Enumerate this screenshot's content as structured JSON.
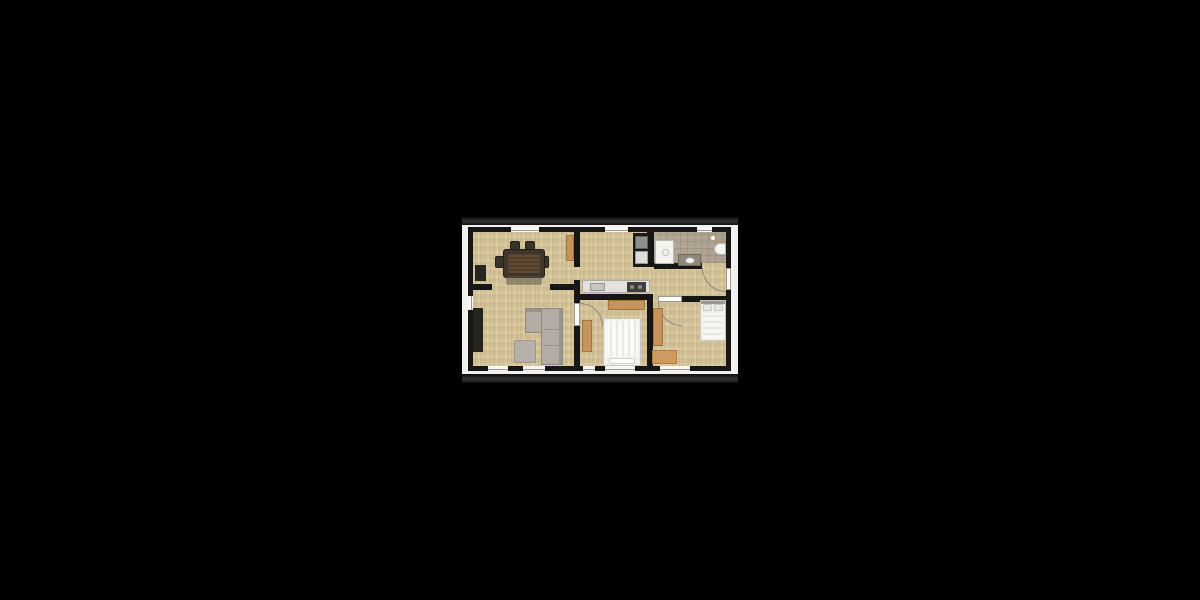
{
  "scene": {
    "description": "2D architectural floor plan of an apartment, letterboxed photo centered on a black background",
    "background_color": "#000000",
    "photo_margin_color": "#f2f1ef",
    "letterbox_bar_color": "#2e2e2e",
    "wall_color": "#161616",
    "wood_floor_color": "#d3c193",
    "tile_floor_color": "#b0a496",
    "wood_furniture_color": "#c5935b",
    "sofa_color": "#b2aca5",
    "bed_color": "#f0eeea",
    "table_color": "#40352b"
  },
  "rooms": [
    {
      "name": "dining-room",
      "position": "top-left",
      "furniture": [
        "dining-table",
        "four-chairs",
        "bench",
        "sideboard",
        "tall-cabinet"
      ],
      "windows": 1
    },
    {
      "name": "kitchen",
      "position": "top-middle",
      "furniture": [
        "appliance-column",
        "counter-with-sink",
        "cooktop"
      ],
      "windows": 1
    },
    {
      "name": "bathroom",
      "position": "top-right",
      "floor": "tile",
      "furniture": [
        "shower",
        "vanity-sink",
        "toilet"
      ],
      "windows": 1
    },
    {
      "name": "living-room",
      "position": "bottom-left",
      "furniture": [
        "corner-sofa",
        "rug",
        "tv-board"
      ],
      "windows": 3
    },
    {
      "name": "bedroom-middle",
      "position": "bottom-middle",
      "furniture": [
        "double-bed",
        "dresser",
        "wardrobe"
      ],
      "windows": 2
    },
    {
      "name": "bedroom-right",
      "position": "bottom-right",
      "furniture": [
        "bed",
        "wardrobe",
        "dresser"
      ],
      "windows": 1
    },
    {
      "name": "hallway",
      "position": "middle-right",
      "furniture": [
        "entry-door"
      ],
      "doors": [
        "entry-door",
        "bathroom-door"
      ]
    }
  ]
}
